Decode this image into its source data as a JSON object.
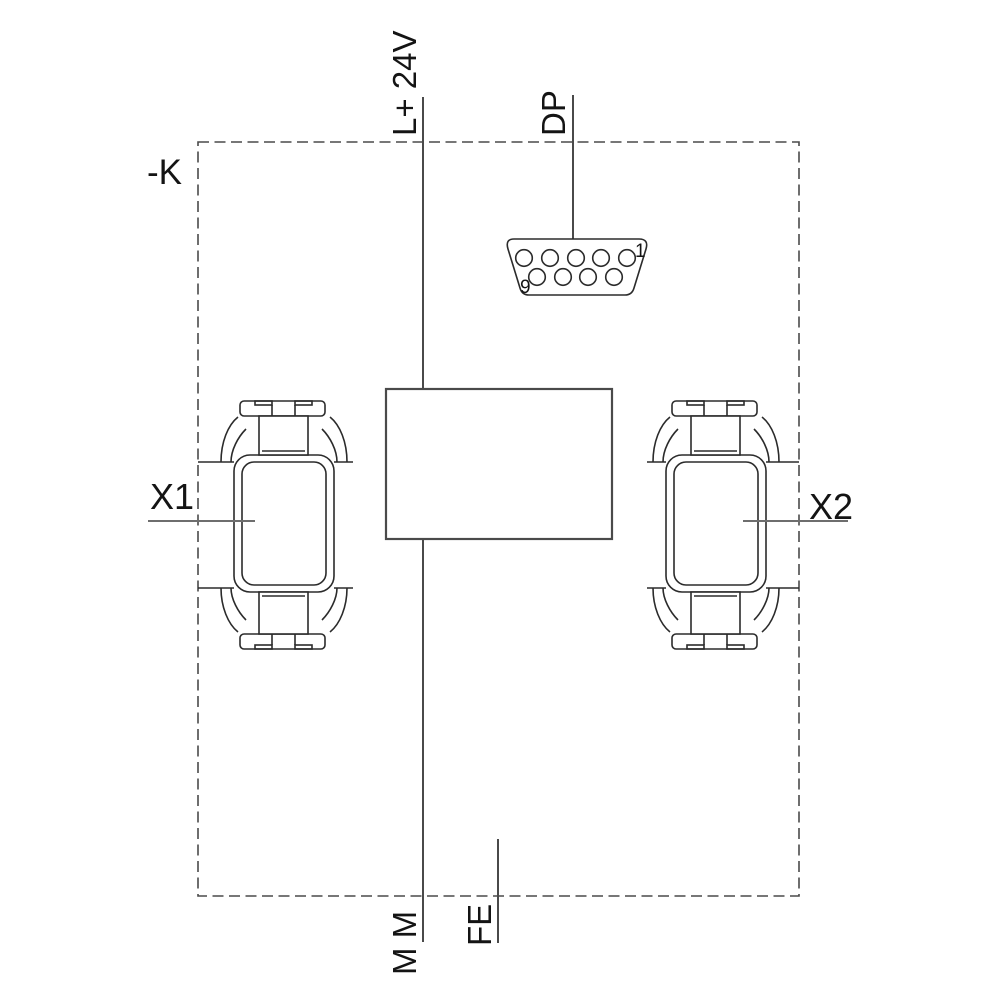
{
  "diagram": {
    "type": "device-connection-diagram",
    "labels": {
      "device": "-K",
      "power": "L+ 24V",
      "dp": "DP",
      "x1": "X1",
      "x2": "X2",
      "ground": "M M",
      "earth": "FE",
      "db9_pin_first": "1",
      "db9_pin_last": "9"
    },
    "components": {
      "enclosure": "dashed boundary rectangle",
      "module_box": "empty rectangle on 24V line",
      "dp_connector": "D-sub 9-pin socket, 5 holes top row, 4 holes bottom row",
      "x1_connector": "port connector symbol left",
      "x2_connector": "port connector symbol right"
    },
    "colors": {
      "background": "#ffffff",
      "line": "#4a4a4a",
      "leader_line": "#6e6e6e",
      "outline": "#2b2b2b",
      "text": "#141414"
    }
  }
}
